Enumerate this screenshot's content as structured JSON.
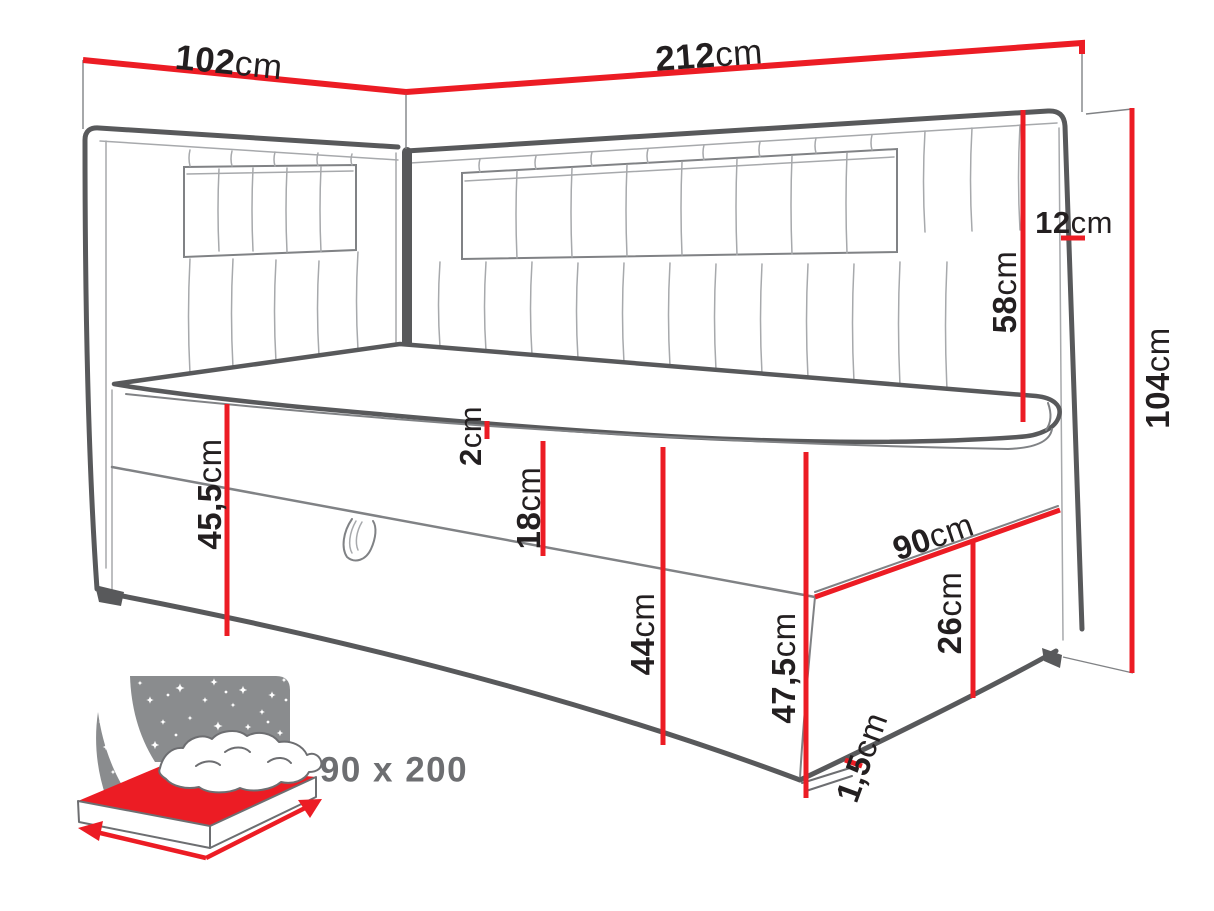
{
  "colors": {
    "dimension_red": "#ec1c24",
    "outline_dark": "#58595b",
    "line_mid": "#808285",
    "line_light": "#a7a9ac",
    "label_text": "#231f20",
    "icon_gray": "#8a8c8e",
    "badge_text": "#6d6e71",
    "background": "#ffffff"
  },
  "dimensions": {
    "d102": {
      "num": "102",
      "unit": "cm"
    },
    "d212": {
      "num": "212",
      "unit": "cm"
    },
    "d12": {
      "num": "12",
      "unit": "cm"
    },
    "d58": {
      "num": "58",
      "unit": "cm"
    },
    "d104": {
      "num": "104",
      "unit": "cm"
    },
    "d45_5": {
      "num": "45,5",
      "unit": "cm"
    },
    "d2": {
      "num": "2",
      "unit": "cm"
    },
    "d18": {
      "num": "18",
      "unit": "cm"
    },
    "d44": {
      "num": "44",
      "unit": "cm"
    },
    "d90": {
      "num": "90",
      "unit": "cm"
    },
    "d26": {
      "num": "26",
      "unit": "cm"
    },
    "d47_5": {
      "num": "47,5",
      "unit": "cm"
    },
    "d1_5": {
      "num": "1,5",
      "unit": "cm"
    }
  },
  "badge": {
    "size_label": "90 x 200"
  }
}
